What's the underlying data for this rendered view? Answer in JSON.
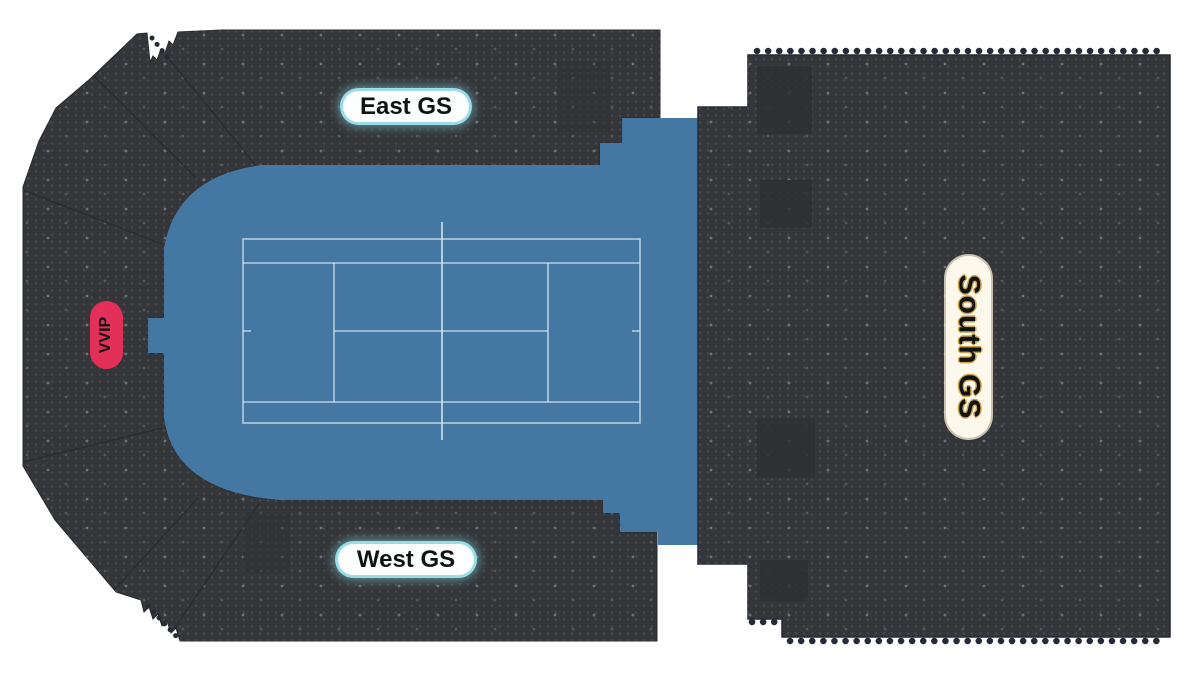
{
  "map": {
    "background": "#ffffff",
    "court": {
      "surface_color": "#4478a3",
      "line_color": "#cfe2ee"
    },
    "stand_color": "#343639",
    "seat_dot_color": "#45484d",
    "labels": {
      "east": "East GS",
      "west": "West GS",
      "vvip": "VVIP",
      "south": "South GS"
    },
    "label_styles": {
      "east_west_bg": "#fdffff",
      "east_west_glow": "#9adde7",
      "vvip_bg": "#e23059",
      "south_bg": "#fdf8ec",
      "south_text_glow": "#c9a24c",
      "text_color": "#111214"
    }
  }
}
